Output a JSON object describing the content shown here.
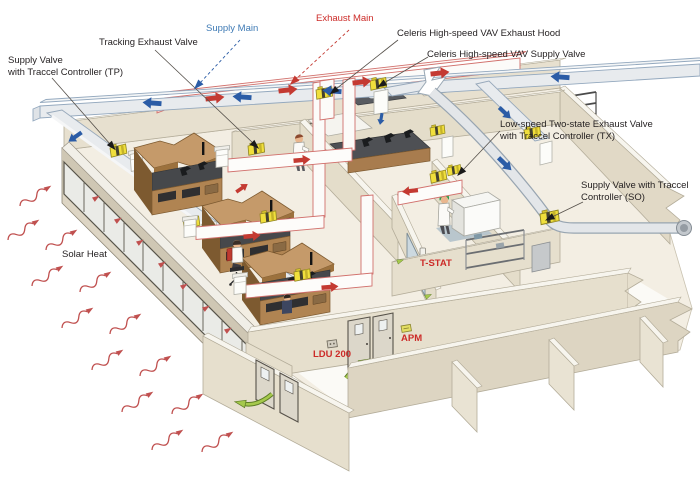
{
  "diagram": {
    "kind": "isometric laboratory airflow-control cutaway",
    "colors": {
      "supply_blue": "#2b5ca6",
      "supply_label_blue": "#3e7ab5",
      "exhaust_red": "#c43a32",
      "red_label": "#cc2b28",
      "valve_yellow": "#f0df3c",
      "solar_wave_red": "#c0504f",
      "green_arrow": "#a5c94c",
      "wall_beige": "#e6dfcd",
      "wood": "#c59a6a",
      "floor": "#f3eee3"
    },
    "labels": {
      "supply_valve_tp": {
        "line1": "Supply Valve",
        "line2": "with Traccel Controller (TP)"
      },
      "tracking_exhaust_valve": {
        "text": "Tracking Exhaust Valve"
      },
      "supply_main": {
        "text": "Supply Main"
      },
      "exhaust_main": {
        "text": "Exhaust Main"
      },
      "celeris_exhaust_hood": {
        "text": "Celeris High-speed VAV Exhaust Hood"
      },
      "celeris_supply_valve": {
        "text": "Celeris High-speed VAV Supply Valve"
      },
      "low_speed_tx": {
        "line1": "Low-speed Two-state Exhaust Valve",
        "line2": "with Traccel Controller (TX)"
      },
      "supply_valve_so": {
        "line1": "Supply Valve with Traccel",
        "line2": "Controller (SO)"
      },
      "solar_heat": {
        "text": "Solar Heat"
      },
      "t_stat": {
        "text": "T-STAT"
      },
      "ldu_200": {
        "text": "LDU 200"
      },
      "apm": {
        "text": "APM"
      }
    }
  }
}
